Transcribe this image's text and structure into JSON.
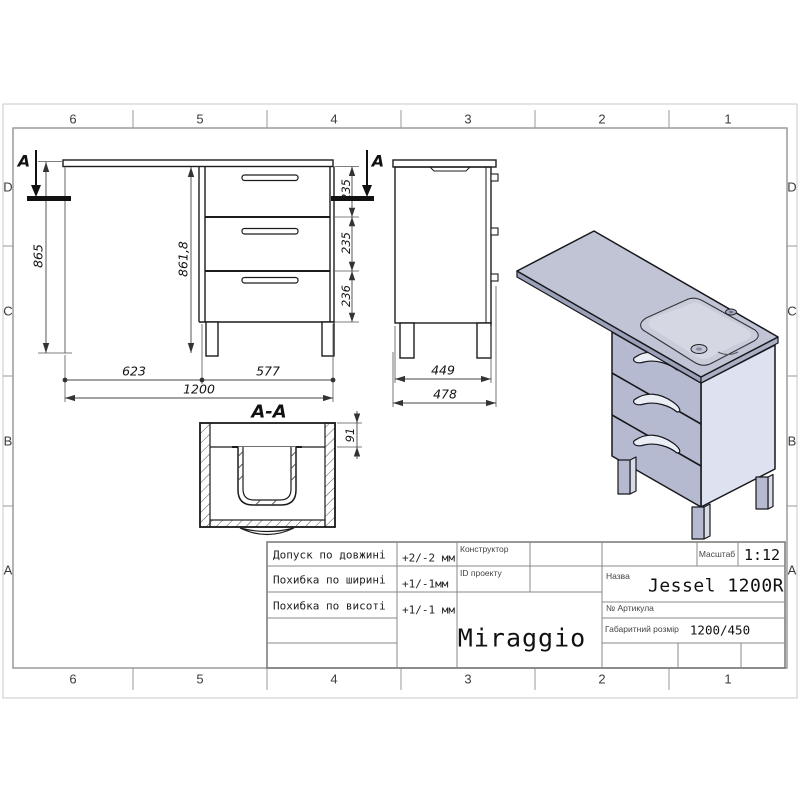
{
  "sheet": {
    "grid_top": [
      "6",
      "5",
      "4",
      "3",
      "2",
      "1"
    ],
    "grid_bottom": [
      "6",
      "5",
      "4",
      "3",
      "2",
      "1"
    ],
    "grid_left": [
      "D",
      "C",
      "B",
      "A"
    ],
    "grid_right": [
      "D",
      "C",
      "B",
      "A"
    ]
  },
  "front_view": {
    "section_letter": "A",
    "height": "865",
    "inner_height": "861,8",
    "drawer_heights": [
      "235",
      "235",
      "236"
    ],
    "width_left": "623",
    "width_right": "577",
    "width_total": "1200"
  },
  "side_view": {
    "depth_inner": "449",
    "depth_total": "478"
  },
  "section_view": {
    "title": "A-A",
    "apron_height": "91"
  },
  "render_3d": {
    "top_color": "#c0c4d4",
    "front_color": "#b5bad1",
    "side_color": "#dee1f0",
    "basin_color": "#d5d8e3"
  },
  "title_block": {
    "tolerances": [
      {
        "label": "Допуск по довжині",
        "value": "+2/-2 мм"
      },
      {
        "label": "Похибка по ширині",
        "value": "+1/-1мм"
      },
      {
        "label": "Похибка по висоті",
        "value": "+1/-1 мм"
      }
    ],
    "designer_label": "Конструктор",
    "project_label": "ID проекту",
    "scale_label": "Масштаб",
    "scale_value": "1:12",
    "name_label": "Назва",
    "name_value": "Jessel 1200R",
    "article_label": "№ Артикула",
    "size_label": "Габаритний розмір",
    "size_value": "1200/450",
    "brand": "Miraggio"
  }
}
